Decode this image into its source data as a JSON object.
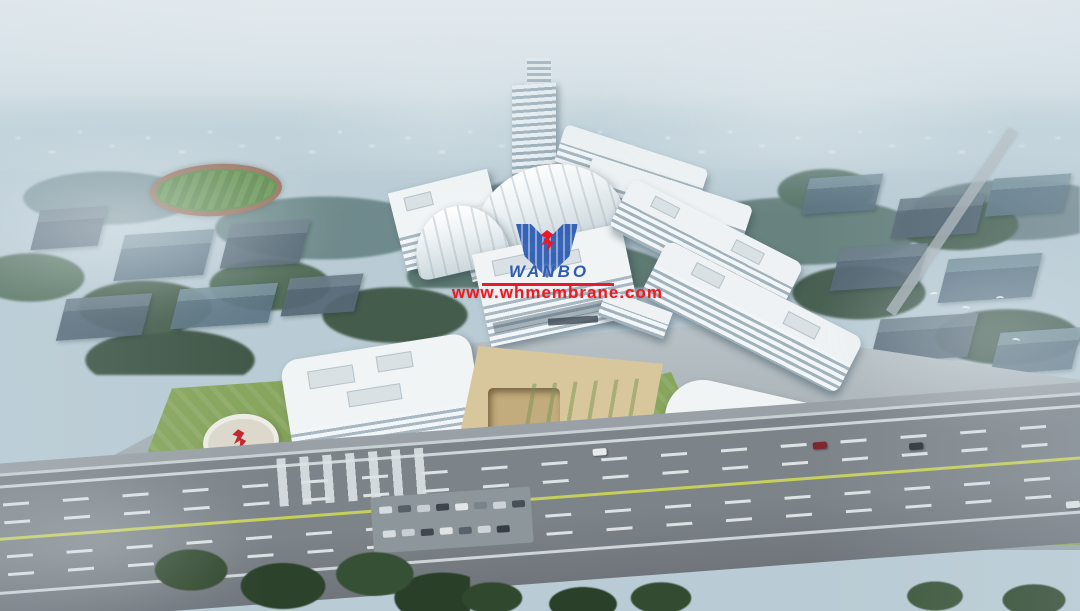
{
  "watermark": {
    "logo_text": "WANBO",
    "url": "www.whmembrane.com",
    "logo_color": "#2b57ae",
    "url_color": "#ec1a24"
  },
  "colors": {
    "sky": "#e8edf0",
    "horizon_haze": "#bed0d8",
    "far_forest": "#6f8a8c",
    "forest": "#4e6757",
    "lawn": "#87a55c",
    "building_white": "#eff3f4",
    "facade_band": "#a0b3bd",
    "highway_asphalt": "#7d8489",
    "median_line": "#c7cf5c",
    "plaza_paving": "#d8c79c",
    "district_block": "#5c6f7c",
    "sculpture_red": "#c3242a"
  }
}
